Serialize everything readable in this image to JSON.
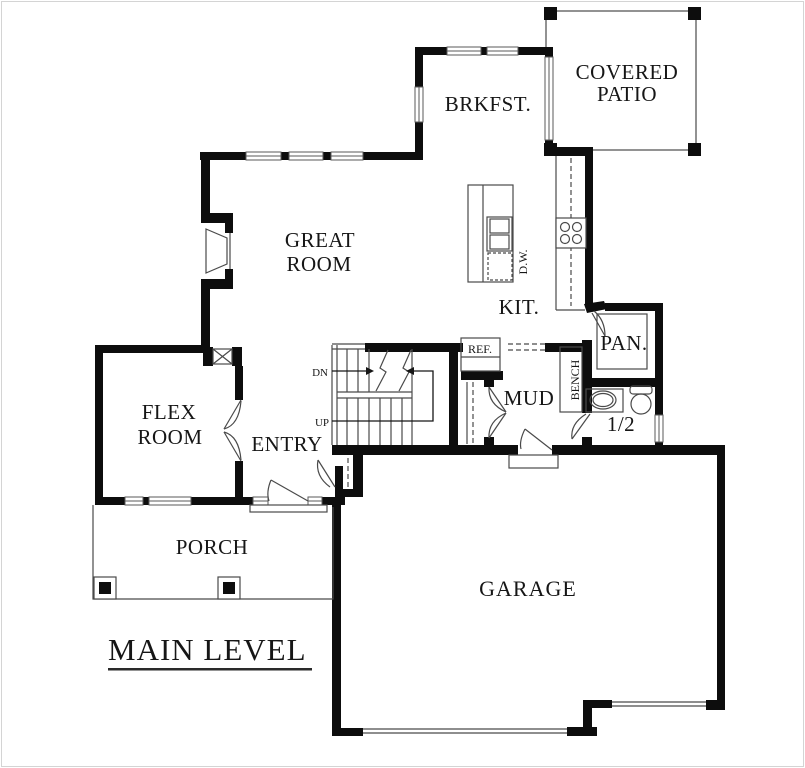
{
  "plan_title": "MAIN LEVEL",
  "rooms": {
    "covered_patio_line1": "COVERED",
    "covered_patio_line2": "PATIO",
    "breakfast": "BRKFST.",
    "great_room_line1": "GREAT",
    "great_room_line2": "ROOM",
    "kitchen": "KIT.",
    "pantry": "PAN.",
    "mud_room": "MUD",
    "half_bath": "1/2",
    "flex_room_line1": "FLEX",
    "flex_room_line2": "ROOM",
    "entry": "ENTRY",
    "porch": "PORCH",
    "garage": "GARAGE"
  },
  "fixtures": {
    "dishwasher": "D.W.",
    "refrigerator": "REF.",
    "bench": "BENCH"
  },
  "stairs": {
    "down": "DN",
    "up": "UP"
  },
  "colors": {
    "wall": "#0d0d0d",
    "thin_line": "#4a4a4a",
    "background": "#ffffff"
  }
}
